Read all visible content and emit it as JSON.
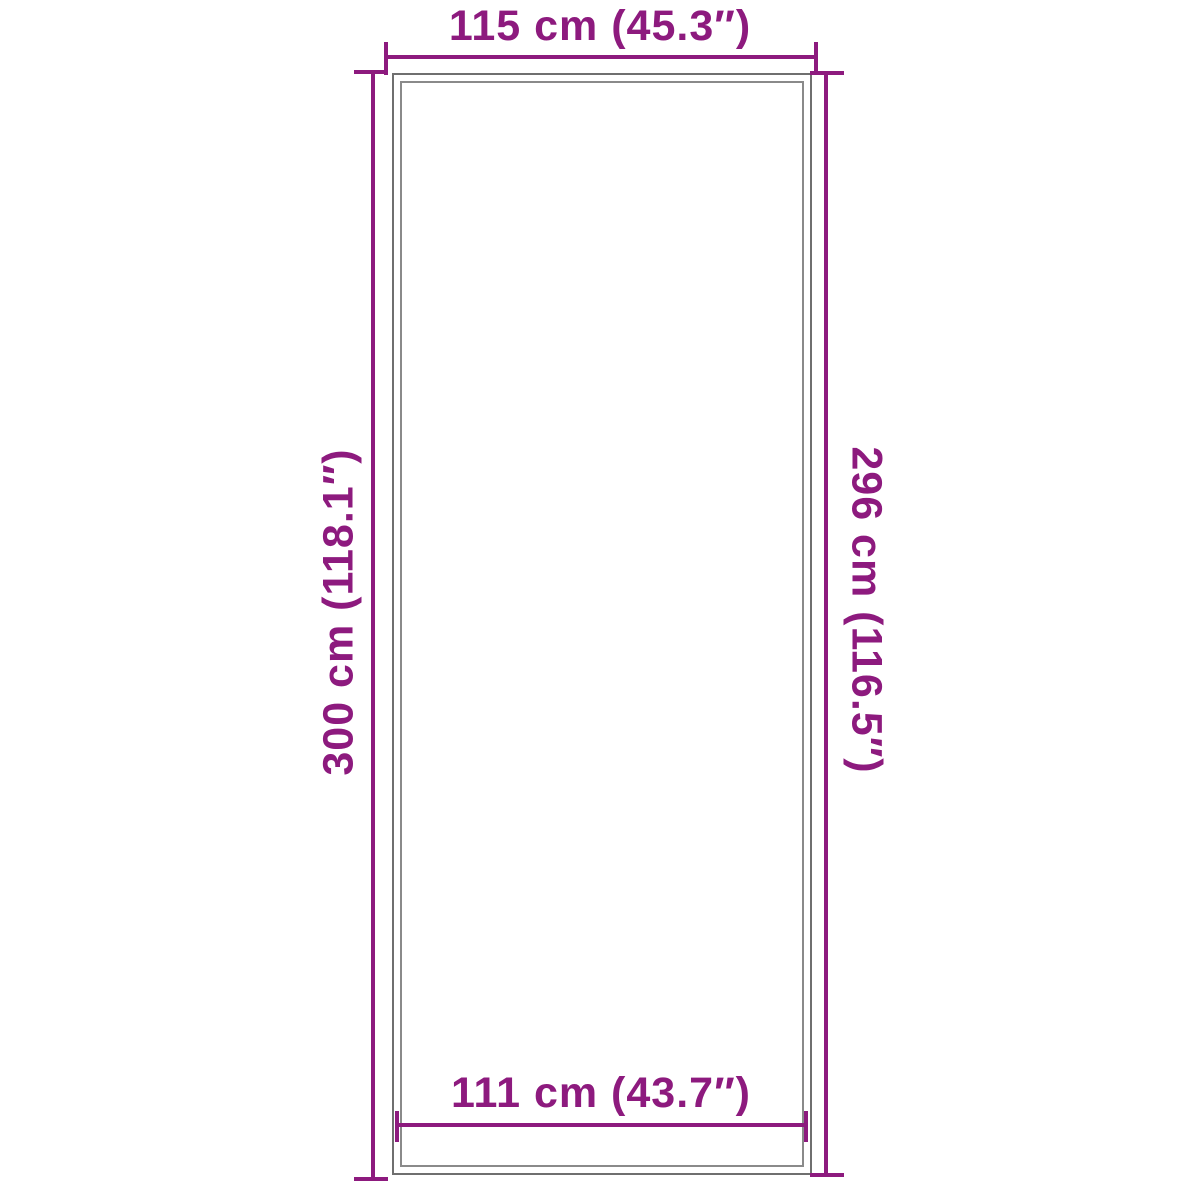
{
  "colors": {
    "accent": "#8d1a7e",
    "outline": "#6f6f6f",
    "outline-inner": "#8a8a8a",
    "background": "#ffffff"
  },
  "diagram": {
    "type": "product-dimension-diagram",
    "top_dimension": "115 cm (45.3″)",
    "left_dimension": "300 cm (118.1″)",
    "right_dimension": "296 cm (116.5″)",
    "bottom_dimension": "111 cm (43.7″)"
  }
}
